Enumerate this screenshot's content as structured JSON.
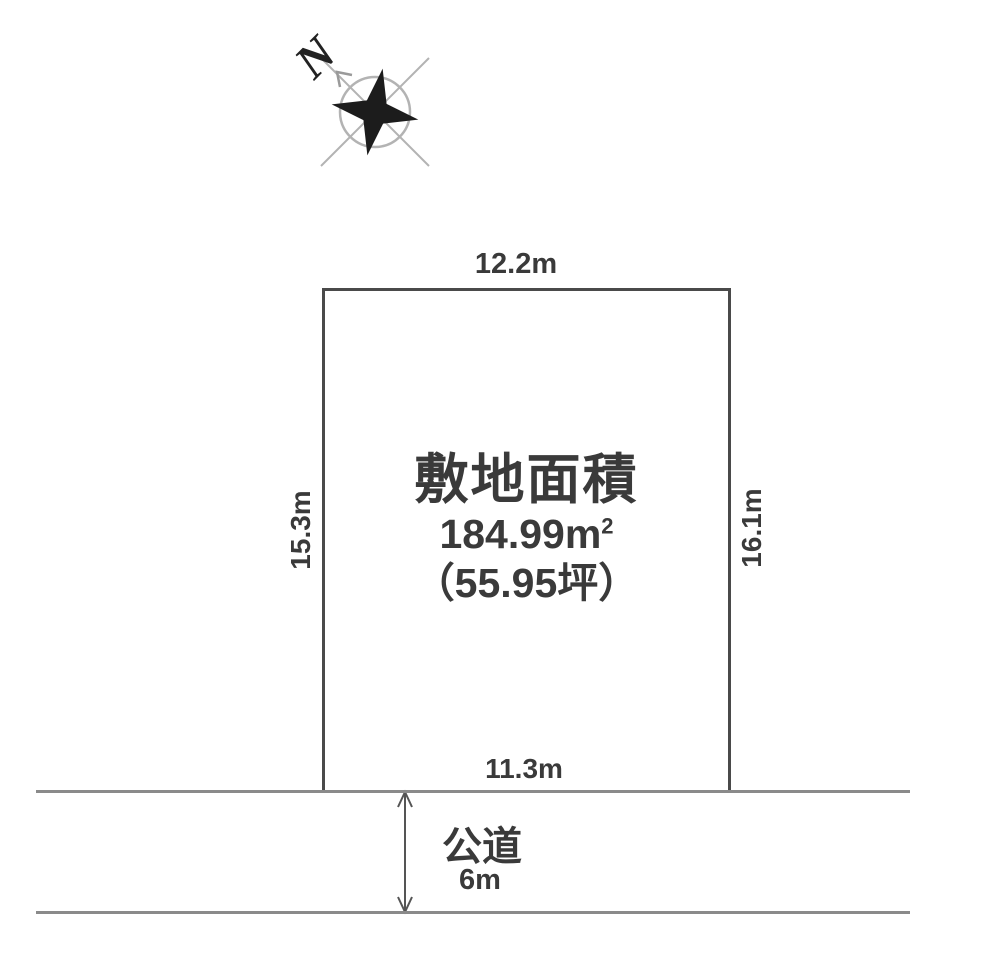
{
  "compass": {
    "north_label": "N"
  },
  "plot": {
    "dimensions": {
      "top": "12.2m",
      "left": "15.3m",
      "right": "16.1m",
      "bottom": "11.3m"
    },
    "area": {
      "title": "敷地面積",
      "value": "184.99m",
      "superscript": "2",
      "tsubo": "（55.95坪）"
    }
  },
  "road": {
    "label": "公道",
    "width": "6m"
  },
  "colors": {
    "ink": "#3a3a3a",
    "plot_border": "#4a4a4a",
    "road_line": "#8a8a8a",
    "compass_gray": "#b3b3b3",
    "star": "#1c1c1c"
  }
}
